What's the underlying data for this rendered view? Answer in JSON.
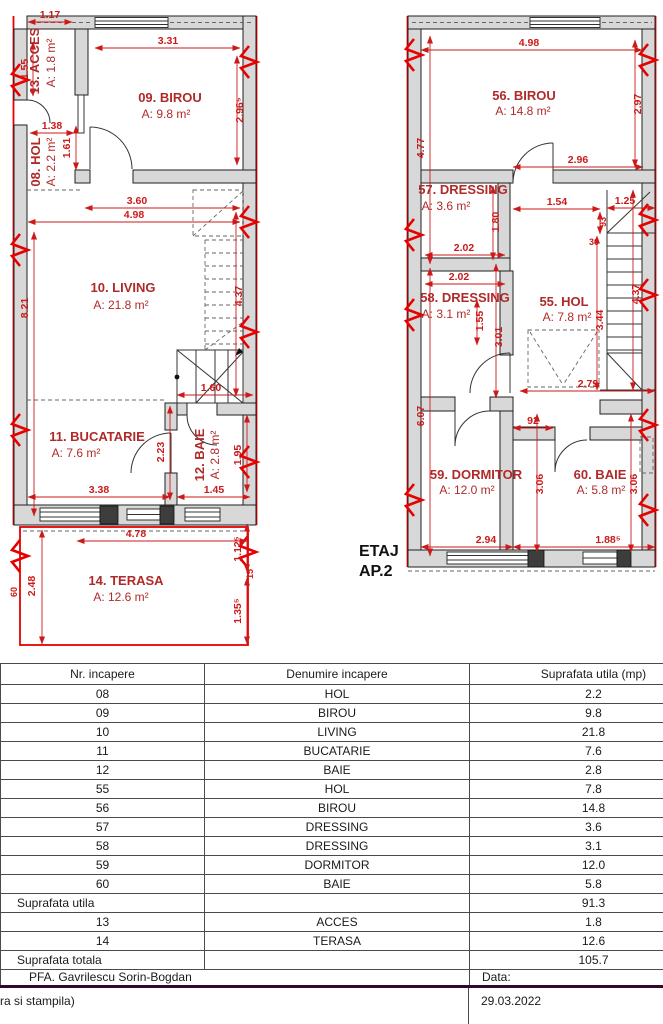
{
  "colors": {
    "dim_red": "#cc1a1a",
    "room_red": "#b02a2a",
    "break_red": "#e60000",
    "wall_fill": "#d8d8d8",
    "wall_stroke": "#1f1f1f",
    "table_thick_line": "#33082b"
  },
  "plans": {
    "caption_line1": "ETAJ",
    "caption_line2": "AP.2",
    "left": {
      "rooms": [
        {
          "name": "13. ACCES",
          "area": "A: 1.8 m²",
          "x": 39,
          "y": 61,
          "ax": 55,
          "ay": 63,
          "rot": 1
        },
        {
          "name": "08. HOL",
          "area": "A: 2.2 m²",
          "x": 40,
          "y": 162,
          "ax": 55,
          "ay": 162,
          "rot": 1
        },
        {
          "name": "09. BIROU",
          "area": "A: 9.8 m²",
          "x": 170,
          "y": 102,
          "ax": 166,
          "ay": 118
        },
        {
          "name": "10. LIVING",
          "area": "A: 21.8 m²",
          "x": 123,
          "y": 292,
          "ax": 121,
          "ay": 309
        },
        {
          "name": "11. BUCATARIE",
          "area": "A: 7.6 m²",
          "x": 97,
          "y": 441,
          "ax": 76,
          "ay": 457
        },
        {
          "name": "12. BAIE",
          "area": "A: 2.8 m²",
          "x": 204,
          "y": 455,
          "ax": 219,
          "ay": 455,
          "rot": 1
        },
        {
          "name": "14. TERASA",
          "area": "A: 12.6 m²",
          "x": 126,
          "y": 585,
          "ax": 121,
          "ay": 601
        }
      ],
      "dims": [
        {
          "t": "1.17",
          "x1": 28,
          "y1": 22,
          "x2": 72,
          "y2": 22,
          "lx": 50,
          "ly": 18
        },
        {
          "t": "1.55",
          "x1": 33,
          "y1": 42,
          "x2": 33,
          "y2": 96,
          "lx": 28,
          "ly": 69,
          "rot": 1
        },
        {
          "t": "1.38",
          "x1": 30,
          "y1": 133,
          "x2": 74,
          "y2": 133,
          "lx": 52,
          "ly": 129
        },
        {
          "t": "1.61",
          "x1": 76,
          "y1": 126,
          "x2": 76,
          "y2": 170,
          "lx": 70,
          "ly": 148,
          "rot": 1
        },
        {
          "t": "3.31",
          "x1": 95,
          "y1": 48,
          "x2": 240,
          "y2": 48,
          "lx": 168,
          "ly": 44
        },
        {
          "t": "2.96⁵",
          "x1": 237,
          "y1": 56,
          "x2": 237,
          "y2": 165,
          "lx": 243,
          "ly": 110,
          "rot": 1
        },
        {
          "t": "3.60",
          "x1": 85,
          "y1": 208,
          "x2": 240,
          "y2": 208,
          "lx": 137,
          "ly": 204
        },
        {
          "t": "4.98",
          "x1": 28,
          "y1": 222,
          "x2": 240,
          "y2": 222,
          "lx": 134,
          "ly": 218
        },
        {
          "t": "8.21",
          "x1": 34,
          "y1": 232,
          "x2": 34,
          "y2": 516,
          "lx": 28,
          "ly": 308,
          "rot": 1
        },
        {
          "t": "4.37",
          "x1": 236,
          "y1": 212,
          "x2": 236,
          "y2": 396,
          "lx": 242,
          "ly": 296,
          "rot": 1
        },
        {
          "t": "1.60",
          "x1": 177,
          "y1": 395,
          "x2": 253,
          "y2": 395,
          "lx": 211,
          "ly": 391
        },
        {
          "t": "2.23",
          "x1": 170,
          "y1": 406,
          "x2": 170,
          "y2": 500,
          "lx": 164,
          "ly": 452,
          "rot": 1
        },
        {
          "t": "1.95",
          "x1": 247,
          "y1": 415,
          "x2": 247,
          "y2": 492,
          "lx": 241,
          "ly": 455,
          "rot": 1
        },
        {
          "t": "3.38",
          "x1": 28,
          "y1": 497,
          "x2": 170,
          "y2": 497,
          "lx": 99,
          "ly": 493
        },
        {
          "t": "1.45",
          "x1": 177,
          "y1": 497,
          "x2": 250,
          "y2": 497,
          "lx": 214,
          "ly": 493
        },
        {
          "t": "4.78",
          "x1": 77,
          "y1": 541,
          "x2": 247,
          "y2": 541,
          "lx": 136,
          "ly": 537
        },
        {
          "t": "1.12⁵",
          "x1": 247,
          "y1": 524,
          "x2": 247,
          "y2": 572,
          "lx": 241,
          "ly": 549,
          "rot": 1
        },
        {
          "t": "2.48",
          "x1": 42,
          "y1": 530,
          "x2": 42,
          "y2": 644,
          "lx": 35,
          "ly": 586,
          "rot": 1
        },
        {
          "t": "1.35⁵",
          "x1": 247,
          "y1": 578,
          "x2": 247,
          "y2": 644,
          "lx": 241,
          "ly": 611,
          "rot": 1
        },
        {
          "t": "60",
          "lx": 17,
          "ly": 592,
          "rot": 1,
          "sm": 1
        },
        {
          "t": "15",
          "lx": 253,
          "ly": 574,
          "rot": 1,
          "sm": 1
        }
      ]
    },
    "right": {
      "rooms": [
        {
          "name": "56. BIROU",
          "area": "A: 14.8 m²",
          "x": 524,
          "y": 100,
          "ax": 523,
          "ay": 115
        },
        {
          "name": "57. DRESSING",
          "area": "A: 3.6 m²",
          "x": 463,
          "y": 194,
          "ax": 446,
          "ay": 210
        },
        {
          "name": "58. DRESSING",
          "area": "A: 3.1 m²",
          "x": 465,
          "y": 302,
          "ax": 446,
          "ay": 318
        },
        {
          "name": "55. HOL",
          "area": "A: 7.8 m²",
          "x": 564,
          "y": 306,
          "ax": 567,
          "ay": 321
        },
        {
          "name": "59. DORMITOR",
          "area": "A: 12.0 m²",
          "x": 476,
          "y": 479,
          "ax": 467,
          "ay": 494
        },
        {
          "name": "60. BAIE",
          "area": "A: 5.8 m²",
          "x": 600,
          "y": 479,
          "ax": 601,
          "ay": 494
        }
      ],
      "dims": [
        {
          "t": "4.98",
          "x1": 421,
          "y1": 50,
          "x2": 642,
          "y2": 50,
          "lx": 529,
          "ly": 46
        },
        {
          "t": "2.97",
          "x1": 635,
          "y1": 40,
          "x2": 635,
          "y2": 167,
          "lx": 641,
          "ly": 104,
          "rot": 1
        },
        {
          "t": "4.77",
          "x1": 430,
          "y1": 36,
          "x2": 430,
          "y2": 264,
          "lx": 424,
          "ly": 148,
          "rot": 1
        },
        {
          "t": "2.96",
          "x1": 513,
          "y1": 167,
          "x2": 643,
          "y2": 167,
          "lx": 578,
          "ly": 163
        },
        {
          "t": "1.54",
          "x1": 513,
          "y1": 209,
          "x2": 600,
          "y2": 209,
          "lx": 557,
          "ly": 205
        },
        {
          "t": "1.25",
          "x1": 607,
          "y1": 208,
          "x2": 655,
          "y2": 208,
          "lx": 625,
          "ly": 204
        },
        {
          "t": "93",
          "x1": 600,
          "y1": 212,
          "x2": 600,
          "y2": 234,
          "lx": 606,
          "ly": 222,
          "rot": 1,
          "sm": 1
        },
        {
          "t": "30",
          "lx": 594,
          "ly": 245,
          "sm": 1
        },
        {
          "t": "1.80",
          "x1": 493,
          "y1": 186,
          "x2": 493,
          "y2": 260,
          "lx": 499,
          "ly": 222,
          "rot": 1
        },
        {
          "t": "2.02",
          "x1": 425,
          "y1": 255,
          "x2": 505,
          "y2": 255,
          "lx": 464,
          "ly": 251
        },
        {
          "t": "2.02",
          "x1": 425,
          "y1": 284,
          "x2": 505,
          "y2": 284,
          "lx": 459,
          "ly": 280
        },
        {
          "t": "1.55",
          "x1": 477,
          "y1": 300,
          "x2": 477,
          "y2": 345,
          "lx": 483,
          "ly": 321,
          "rot": 1
        },
        {
          "t": "3.01",
          "x1": 496,
          "y1": 264,
          "x2": 496,
          "y2": 398,
          "lx": 502,
          "ly": 337,
          "rot": 1
        },
        {
          "t": "3.44",
          "x1": 597,
          "y1": 236,
          "x2": 597,
          "y2": 390,
          "lx": 603,
          "ly": 320,
          "rot": 1
        },
        {
          "t": "4.37",
          "x1": 633,
          "y1": 190,
          "x2": 633,
          "y2": 390,
          "lx": 639,
          "ly": 294,
          "rot": 1
        },
        {
          "t": "6.07",
          "x1": 430,
          "y1": 268,
          "x2": 430,
          "y2": 556,
          "lx": 424,
          "ly": 416,
          "rot": 1
        },
        {
          "t": "2.79",
          "x1": 520,
          "y1": 391,
          "x2": 655,
          "y2": 391,
          "lx": 588,
          "ly": 387
        },
        {
          "t": "92",
          "x1": 513,
          "y1": 428,
          "x2": 553,
          "y2": 428,
          "lx": 533,
          "ly": 424
        },
        {
          "t": "3.06",
          "x1": 537,
          "y1": 414,
          "x2": 537,
          "y2": 552,
          "lx": 543,
          "ly": 484,
          "rot": 1
        },
        {
          "t": "3.06",
          "x1": 631,
          "y1": 414,
          "x2": 631,
          "y2": 552,
          "lx": 637,
          "ly": 484,
          "rot": 1
        },
        {
          "t": "2.94",
          "x1": 421,
          "y1": 547,
          "x2": 513,
          "y2": 547,
          "lx": 486,
          "ly": 543
        },
        {
          "t": "1.88⁵",
          "x1": 513,
          "y1": 547,
          "x2": 655,
          "y2": 547,
          "lx": 608,
          "ly": 543
        }
      ]
    }
  },
  "table": {
    "headers": [
      "Nr. incapere",
      "Denumire incapere",
      "Suprafata utila (mp)"
    ],
    "rows": [
      [
        "08",
        "HOL",
        "2.2"
      ],
      [
        "09",
        "BIROU",
        "9.8"
      ],
      [
        "10",
        "LIVING",
        "21.8"
      ],
      [
        "11",
        "BUCATARIE",
        "7.6"
      ],
      [
        "12",
        "BAIE",
        "2.8"
      ],
      [
        "55",
        "HOL",
        "7.8"
      ],
      [
        "56",
        "BIROU",
        "14.8"
      ],
      [
        "57",
        "DRESSING",
        "3.6"
      ],
      [
        "58",
        "DRESSING",
        "3.1"
      ],
      [
        "59",
        "DORMITOR",
        "12.0"
      ],
      [
        "60",
        "BAIE",
        "5.8"
      ]
    ],
    "subtotal": {
      "label": "Suprafata utila",
      "value": "91.3"
    },
    "extra_rows": [
      [
        "13",
        "ACCES",
        "1.8"
      ],
      [
        "14",
        "TERASA",
        "12.6"
      ]
    ],
    "total": {
      "label": "Suprafata totala",
      "value": "105.7"
    },
    "author_row": {
      "left": "PFA. Gavrilescu Sorin-Bogdan",
      "right": "Data:"
    },
    "stamp_row": {
      "left": "ra si stampila)",
      "right": "29.03.2022"
    }
  }
}
